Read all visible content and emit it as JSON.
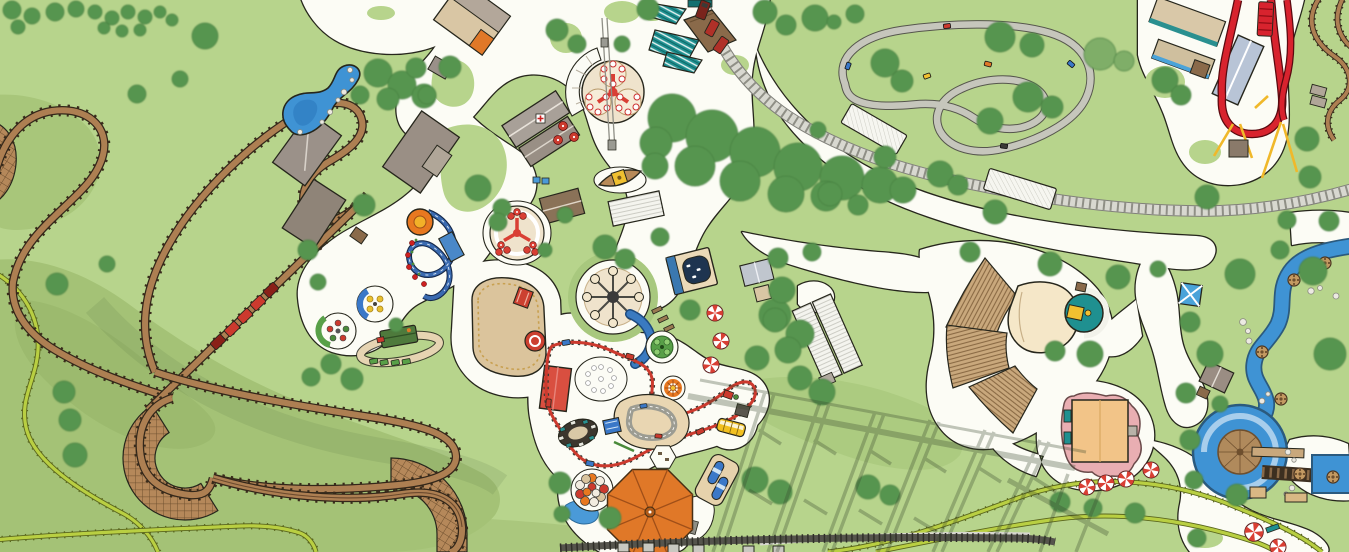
{
  "meta": {
    "title": "Illustrated amusement park map",
    "description": "Hand-drawn overhead theme park map with roller coasters, kiddie rides, go-kart track, railroad, amphitheater and rapids river; no visible text labels",
    "visible_text": "none"
  },
  "colors": {
    "grass": "#b7d48c",
    "grassShade": "#a4c276",
    "grassShade2": "#96b468",
    "path": "#fcfcf5",
    "outline": "#26261c",
    "treeFill": "#57954f",
    "treeEdge": "#447c3e",
    "treeLight": "#7fae68",
    "water": "#3f93d4",
    "waterDeep": "#2f7cc0",
    "woodTrack": "#ad7f52",
    "woodDark": "#33271a",
    "woodTie": "#3a2c1c",
    "latticeFill": "#b5885a",
    "latticeLine": "#6e4f2e",
    "railBase": "#d8d8d0",
    "railTie": "#8f8f86",
    "kartTrack": "#c6c6bc",
    "kartEdge": "#55554c",
    "chartreuse": "#b9cf42",
    "chartreuseEdge": "#5a661e",
    "shadow": "#36452c",
    "redRide": "#cc3a2e",
    "redCoaster": "#d8232e",
    "yellowSupport": "#f0b82a",
    "teal": "#1f9090",
    "navy": "#1e3450",
    "blue": "#3a78c8",
    "skyBlue": "#4a9ad8",
    "tan": "#d9c6a4",
    "sand": "#dbc49c",
    "tanLight": "#efe3cc",
    "brown": "#8a6a4a",
    "brownRoof": "#8a7258",
    "greyRoof": "#9b9189",
    "greyLight": "#e4e4dc",
    "orange": "#e07828",
    "orangeDark": "#a04f18",
    "yellow": "#f0c030",
    "pink": "#e9aeb2",
    "stage": "#f5e7c8",
    "seating": "#c9a87c",
    "seatLine": "#8a6a44",
    "stationRoof": "#b8c4d6",
    "candyRed": "#d93f34"
  },
  "features": [
    {
      "name": "wooden-coaster",
      "kind": "roller-coaster"
    },
    {
      "name": "wooden-coaster-train",
      "kind": "coaster-train",
      "cars": 5
    },
    {
      "name": "wooden-coaster-station",
      "kind": "building-cluster"
    },
    {
      "name": "banked-turn-lattice",
      "kind": "coaster-structure",
      "count": 3
    },
    {
      "name": "chartreuse-coaster",
      "kind": "roller-coaster"
    },
    {
      "name": "red-launch-coaster",
      "kind": "roller-coaster"
    },
    {
      "name": "coaster-structure-shadow",
      "kind": "shadow"
    },
    {
      "name": "go-kart-track",
      "kind": "ride"
    },
    {
      "name": "go-karts",
      "kind": "vehicles",
      "count": 6
    },
    {
      "name": "railroad",
      "kind": "train-track"
    },
    {
      "name": "park-train",
      "kind": "train",
      "cars": 3
    },
    {
      "name": "railroad-platforms",
      "kind": "platform",
      "count": 2
    },
    {
      "name": "pond",
      "kind": "water"
    },
    {
      "name": "rapids-river",
      "kind": "water-ride"
    },
    {
      "name": "rapids-turntable",
      "kind": "ride-platform"
    },
    {
      "name": "rapids-rafts",
      "kind": "vehicles",
      "count": 6
    },
    {
      "name": "amphitheater",
      "kind": "venue",
      "seating_sections": 3
    },
    {
      "name": "stage-dome",
      "kind": "stage"
    },
    {
      "name": "carousel-pavilion",
      "kind": "building"
    },
    {
      "name": "bumper-cars-building",
      "kind": "ride-building"
    },
    {
      "name": "trefoil-spinner",
      "kind": "flat-ride"
    },
    {
      "name": "wave-swinger",
      "kind": "flat-ride"
    },
    {
      "name": "scrambler",
      "kind": "flat-ride"
    },
    {
      "name": "kiddie-coaster",
      "kind": "roller-coaster"
    },
    {
      "name": "teacup-ride",
      "kind": "kiddie-ride"
    },
    {
      "name": "orange-spinner",
      "kind": "kiddie-ride"
    },
    {
      "name": "canopy-ride-a",
      "kind": "kiddie-ride"
    },
    {
      "name": "canopy-ride-b",
      "kind": "kiddie-ride"
    },
    {
      "name": "kiddie-train",
      "kind": "kiddie-ride"
    },
    {
      "name": "driving-school",
      "kind": "kiddie-ride"
    },
    {
      "name": "himalaya-ride",
      "kind": "kiddie-ride"
    },
    {
      "name": "balloon-ride",
      "kind": "kiddie-ride"
    },
    {
      "name": "umbrella-canopy",
      "kind": "canopy"
    },
    {
      "name": "school-bus-ride",
      "kind": "kiddie-ride"
    },
    {
      "name": "capsule-ride",
      "kind": "kiddie-ride"
    },
    {
      "name": "sand-playground",
      "kind": "play-area"
    },
    {
      "name": "green-train-ride",
      "kind": "kiddie-ride"
    },
    {
      "name": "sky-lift-cables",
      "kind": "cable-ride"
    },
    {
      "name": "boat-ride",
      "kind": "kiddie-ride"
    },
    {
      "name": "teal-market-tents",
      "kind": "canopy",
      "count": 3
    },
    {
      "name": "white-pavilion",
      "kind": "building"
    },
    {
      "name": "picnic-table-plaza",
      "kind": "furniture"
    },
    {
      "name": "peppermint-markers",
      "kind": "map-marker",
      "count": 9
    },
    {
      "name": "blue-shade-square",
      "kind": "canopy"
    },
    {
      "name": "river-hut",
      "kind": "building"
    },
    {
      "name": "market-buildings",
      "kind": "building-cluster"
    },
    {
      "name": "bottom-edge-coaster-track",
      "kind": "coaster-structure"
    },
    {
      "name": "trees",
      "kind": "vegetation"
    }
  ]
}
